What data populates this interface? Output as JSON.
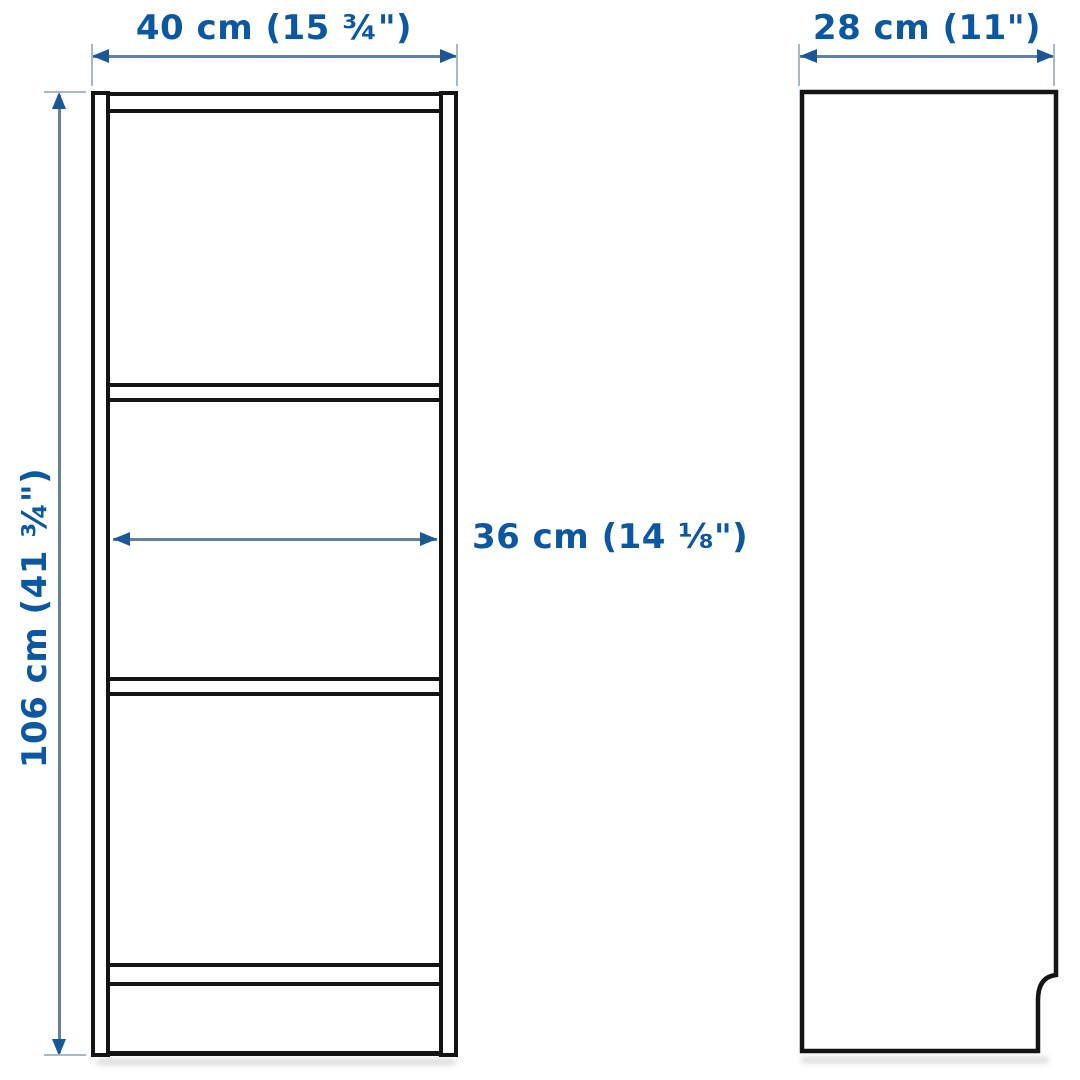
{
  "diagram_type": "furniture-dimension-diagram (bookcase, front and side orthographic views)",
  "dimensions": {
    "front_width": "40 cm (15 ¾\")",
    "side_depth": "28 cm (11\")",
    "height": "106 cm (41 ¾\")",
    "inner_width": "36 cm (14 ⅛\")"
  },
  "icons": {
    "arrowhead": "solid-triangle"
  },
  "colors": {
    "label_text": "#0b57a0",
    "dimension_line": "#64809f",
    "arrowhead": "#1a5796",
    "extension_line": "#a7b8ca",
    "furniture_outline": "#141414",
    "background": "#ffffff"
  }
}
